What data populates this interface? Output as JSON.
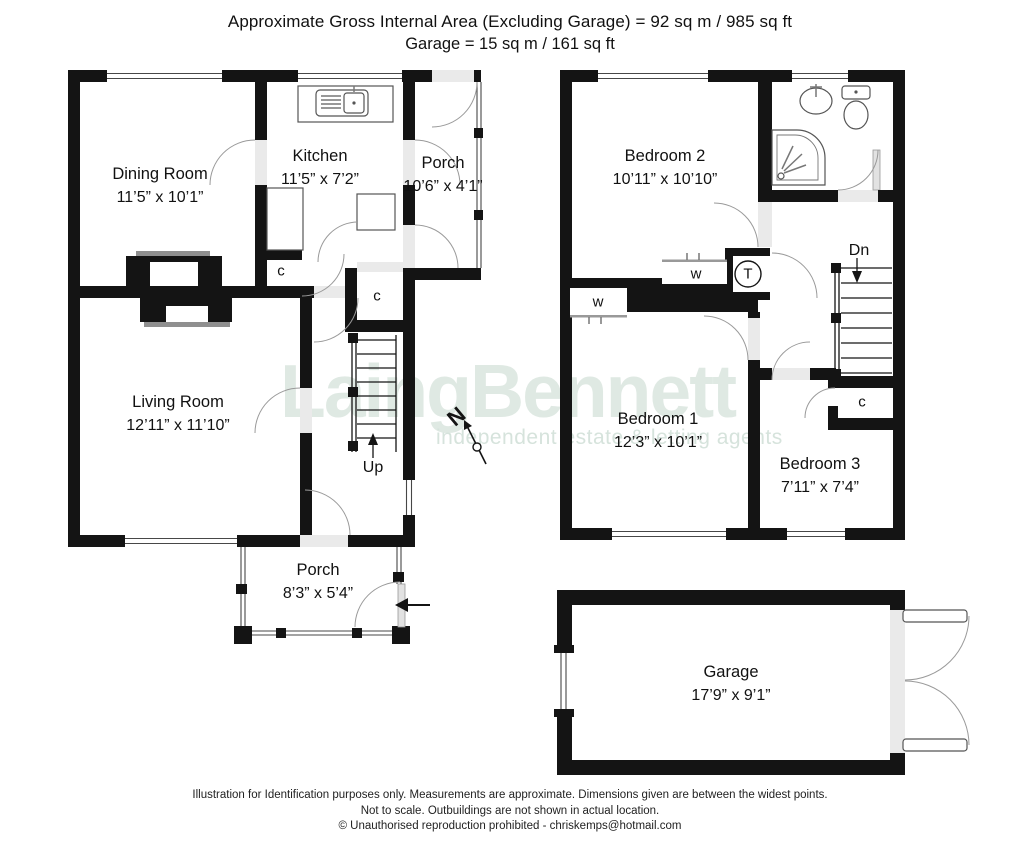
{
  "header": {
    "line1": "Approximate Gross Internal Area (Excluding Garage)  =  92 sq m / 985 sq ft",
    "line2": "Garage  =  15 sq m  /  161 sq ft"
  },
  "floors": {
    "ground": {
      "rooms": [
        {
          "id": "dining-room",
          "name": "Dining Room",
          "dims": "11’5” x 10’1”"
        },
        {
          "id": "kitchen",
          "name": "Kitchen",
          "dims": "11’5” x 7’2”"
        },
        {
          "id": "porch-top",
          "name": "Porch",
          "dims": "10’6” x 4’1”"
        },
        {
          "id": "living-room",
          "name": "Living Room",
          "dims": "12’11” x 11’10”"
        },
        {
          "id": "porch-bottom",
          "name": "Porch",
          "dims": "8’3” x 5’4”"
        }
      ],
      "stairs_label": "Up"
    },
    "first": {
      "rooms": [
        {
          "id": "bedroom-2",
          "name": "Bedroom 2",
          "dims": "10’11” x 10’10”"
        },
        {
          "id": "bedroom-1",
          "name": "Bedroom 1",
          "dims": "12’3” x 10’1”"
        },
        {
          "id": "bedroom-3",
          "name": "Bedroom 3",
          "dims": "7’11” x 7’4”"
        }
      ],
      "stairs_label": "Dn"
    },
    "garage": {
      "name": "Garage",
      "dims": "17’9” x 9’1”"
    }
  },
  "symbols": {
    "closet": "c",
    "wardrobe": "w",
    "tank": "T",
    "north": "N"
  },
  "watermark": {
    "brand": "LaingBennett",
    "tagline": "independent  estate & letting agents"
  },
  "footer": {
    "line1": "Illustration for Identification purposes only.  Measurements are approximate. Dimensions given are between the widest points.",
    "line2": "Not to scale.  Outbuildings are not shown in actual location.",
    "line3": "© Unauthorised reproduction prohibited  -  chriskemps@hotmail.com"
  },
  "colors": {
    "wall": "#141414",
    "door_arc": "#9a9a9a",
    "opening_shade": "#eaeaea",
    "watermark": "#dfe9e3"
  }
}
